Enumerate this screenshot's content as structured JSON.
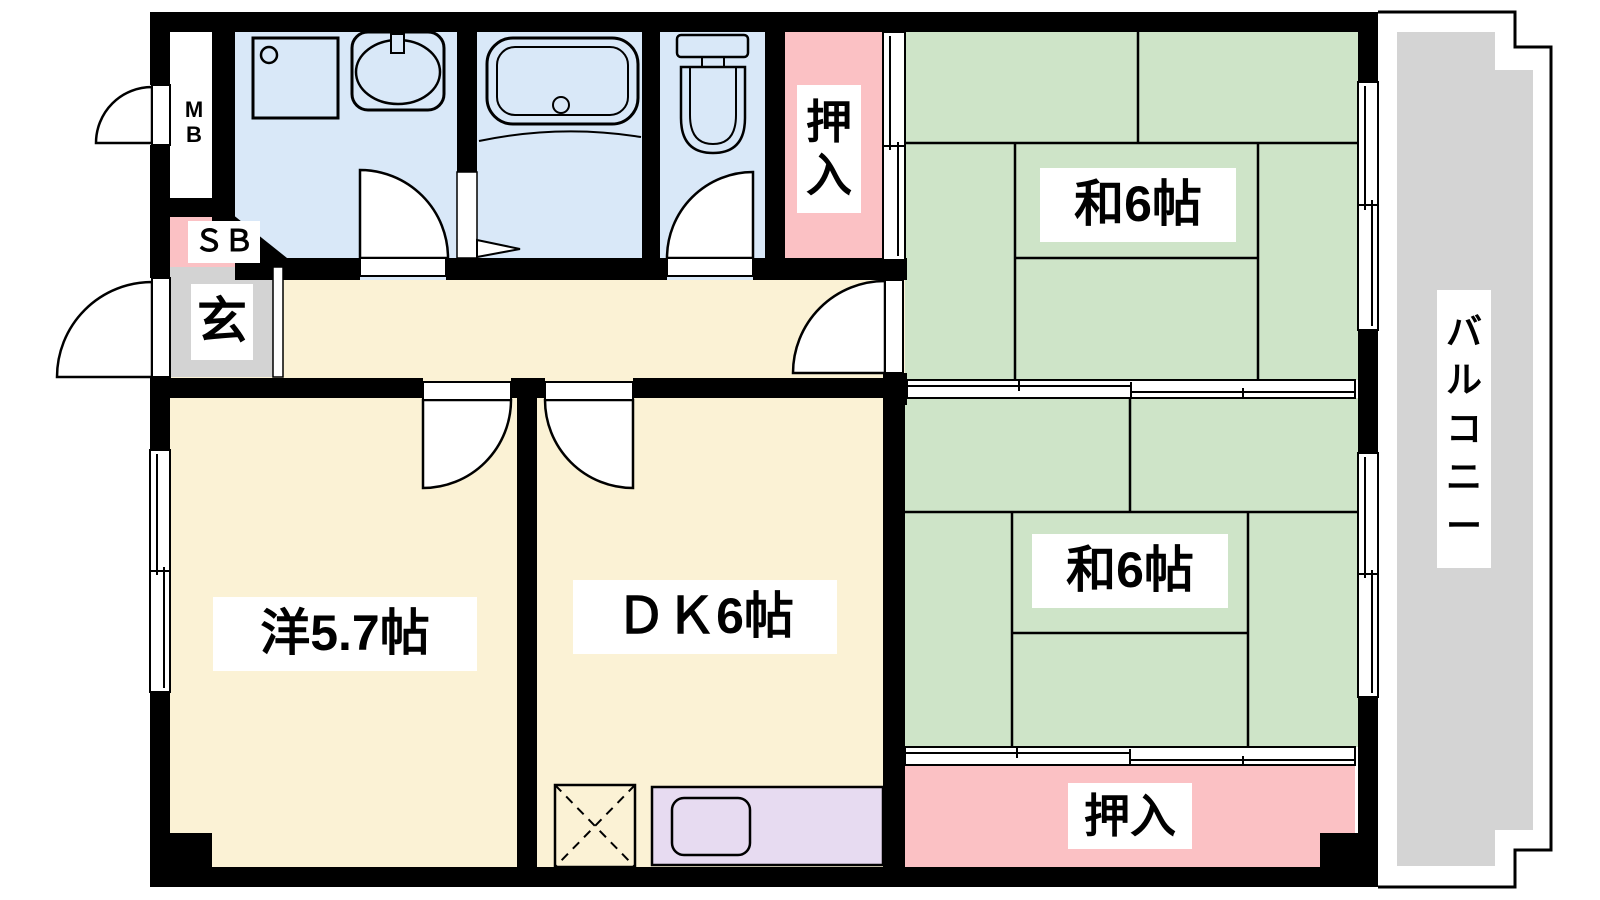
{
  "rooms": {
    "washitsu_top": {
      "label": "和6帖",
      "type": "japanese-tatami-room",
      "size_jo": 6
    },
    "washitsu_bottom": {
      "label": "和6帖",
      "type": "japanese-tatami-room",
      "size_jo": 6
    },
    "dining_kitchen": {
      "label": "ＤＫ6帖",
      "type": "dining-kitchen",
      "size_jo": 6
    },
    "western_room": {
      "label": "洋5.7帖",
      "type": "western-room",
      "size_jo": 5.7
    },
    "closet_top": {
      "label": "押\n入",
      "type": "oshiire-closet"
    },
    "closet_bottom": {
      "label": "押入",
      "type": "oshiire-closet"
    },
    "entrance": {
      "label": "玄",
      "type": "genkan-entrance"
    },
    "shoe_box": {
      "label": "ＳＢ",
      "type": "shoe-box"
    },
    "meter_box": {
      "label": "M\nB",
      "type": "meter-box"
    },
    "balcony": {
      "label": "バ\nル\nコ\nニ\nー",
      "type": "balcony"
    }
  },
  "colors": {
    "tatami_green": "#cee4c8",
    "room_cream": "#fbf2d5",
    "water_blue": "#d9e8f8",
    "closet_pink": "#fbc1c4",
    "entrance_gray": "#d3d3d3",
    "balcony_gray": "#d4d4d4",
    "counter_purple": "#e7dbf1",
    "wall_black": "#000000"
  }
}
